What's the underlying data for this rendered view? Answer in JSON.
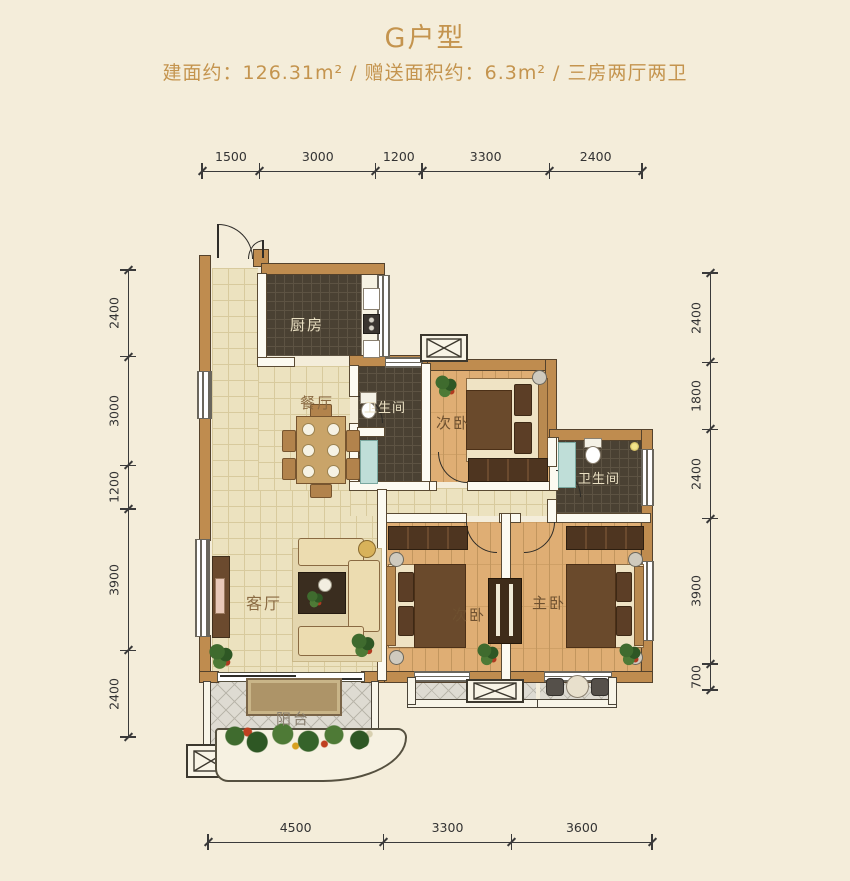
{
  "title": "G户型",
  "subtitle": "建面约：126.31m² / 赠送面积约：6.3m² / 三房两厅两卫",
  "colors": {
    "accent_gold": "#c4944e",
    "background": "#f4edda",
    "wall_fill": "#bf8c4f",
    "wall_outline": "#54422c",
    "floor_tile": "#ece2bf",
    "floor_wood": "#dfae74",
    "floor_dark_tile": "#4a4133",
    "balcony_tile": "#dedbd2",
    "dimension_line": "#3a3a3a"
  },
  "rooms": {
    "kitchen": {
      "label": "厨房"
    },
    "dining": {
      "label": "餐厅"
    },
    "bath1": {
      "label": "卫生间"
    },
    "bath2": {
      "label": "卫生间"
    },
    "bedroom_top": {
      "label": "次卧"
    },
    "bedroom_bottom": {
      "label": "次卧"
    },
    "master": {
      "label": "主卧"
    },
    "living": {
      "label": "客厅"
    },
    "balcony": {
      "label": "阳台"
    }
  },
  "dimensions": {
    "top": [
      1500,
      3000,
      1200,
      3300,
      2400
    ],
    "left": [
      2400,
      3000,
      1200,
      3900,
      2400
    ],
    "right": [
      2400,
      1800,
      2400,
      3900,
      700
    ],
    "bottom": [
      4500,
      3300,
      3600
    ]
  }
}
